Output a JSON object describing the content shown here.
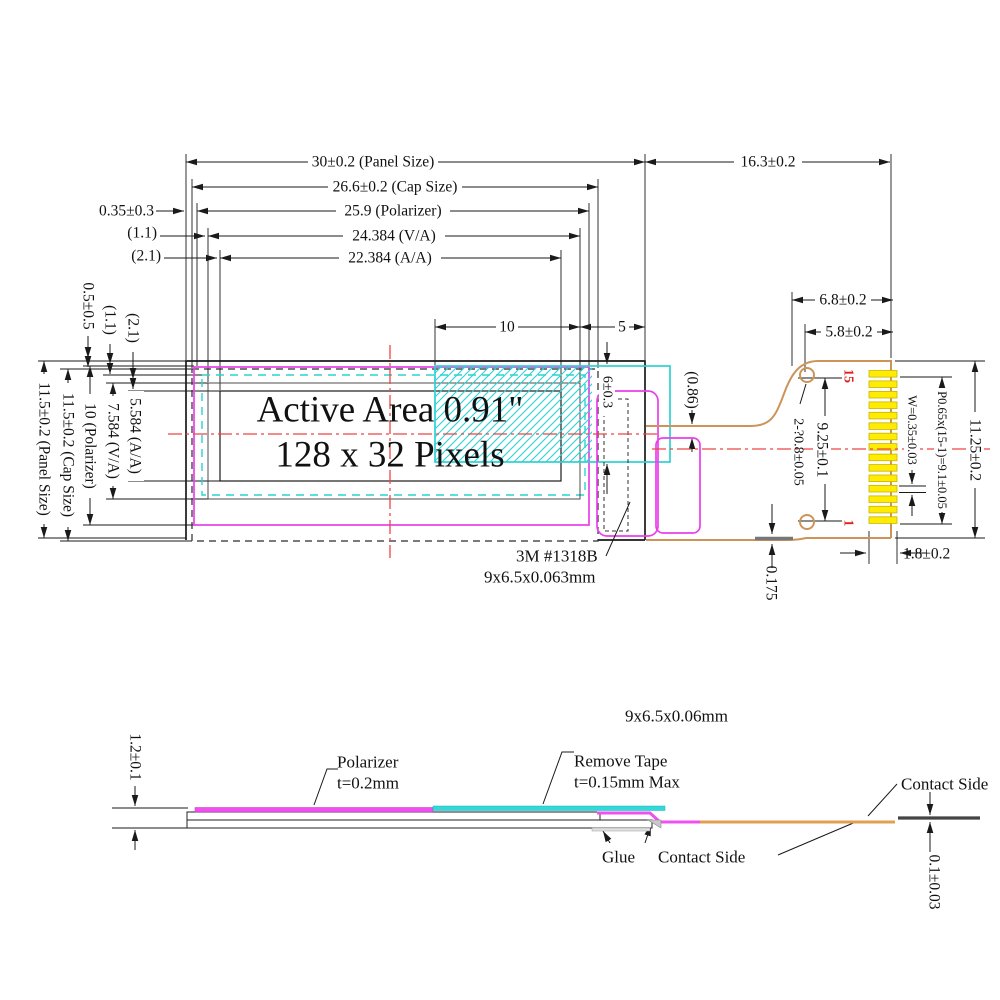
{
  "drawing": {
    "active_area_line1": "Active Area 0.91\"",
    "active_area_line2": "128 x 32 Pixels"
  },
  "top_dims": {
    "panel_w": "30±0.2 (Panel Size)",
    "cap_w": "26.6±0.2 (Cap Size)",
    "polarizer_w": "25.9 (Polarizer)",
    "va_w": "24.384 (V/A)",
    "aa_w": "22.384 (A/A)",
    "offset_035": "0.35±0.3",
    "offset_11": "(1.1)",
    "offset_21": "(2.1)",
    "fpc_length": "16.3±0.2",
    "tape_10": "10",
    "tape_5": "5"
  },
  "left_dims": {
    "panel_h": "11.5±0.2 (Panel Size)",
    "cap_h": "11.5±0.2 (Cap Size)",
    "polarizer_h": "10 (Polarizer)",
    "va_h": "7.584 (V/A)",
    "aa_h": "5.584 (A/A)",
    "offset_05": "0.5±0.5",
    "offset_11": "(1.1)",
    "offset_21": "(2.1)"
  },
  "right_dims": {
    "fpc_neck": "6.8±0.2",
    "fpc_neck2": "5.8±0.2",
    "hole_pitch": "9.25±0.1",
    "holes": "2-?0.8±0.05",
    "pin_pitch": "P0.65x(15-1)=9.1±0.05",
    "pin_width": "W=0.35±0.03",
    "conn_height": "11.25±0.2",
    "pin_row_width": "1.8±0.2",
    "fpc_thickness": "0.175",
    "gap": "(0.86)",
    "tape_height": "6±0.3"
  },
  "notes": {
    "tape_line1": "3M #1318B",
    "tape_line2": "9x6.5x0.063mm"
  },
  "connector": {
    "pin_count": 15,
    "pin_top_label": "15",
    "pin_bottom_label": "1"
  },
  "section": {
    "size_note": "9x6.5x0.06mm",
    "stack_thickness": "1.2±0.1",
    "polarizer_l1": "Polarizer",
    "polarizer_l2": "t=0.2mm",
    "tape_l1": "Remove Tape",
    "tape_l2": "t=0.15mm Max",
    "glue": "Glue",
    "contact_top": "Contact Side",
    "contact_bottom": "Contact Side",
    "fpc_thickness": "0.1±0.03"
  },
  "colors": {
    "line_black": "#1a1a1a",
    "magenta": "#e93fe9",
    "cyan": "#2bd2d2",
    "centerline_red": "#ef4545",
    "fpc_tan": "#cd9459",
    "pin_yellow": "#ffec00",
    "pin_label_red": "#e02020"
  }
}
